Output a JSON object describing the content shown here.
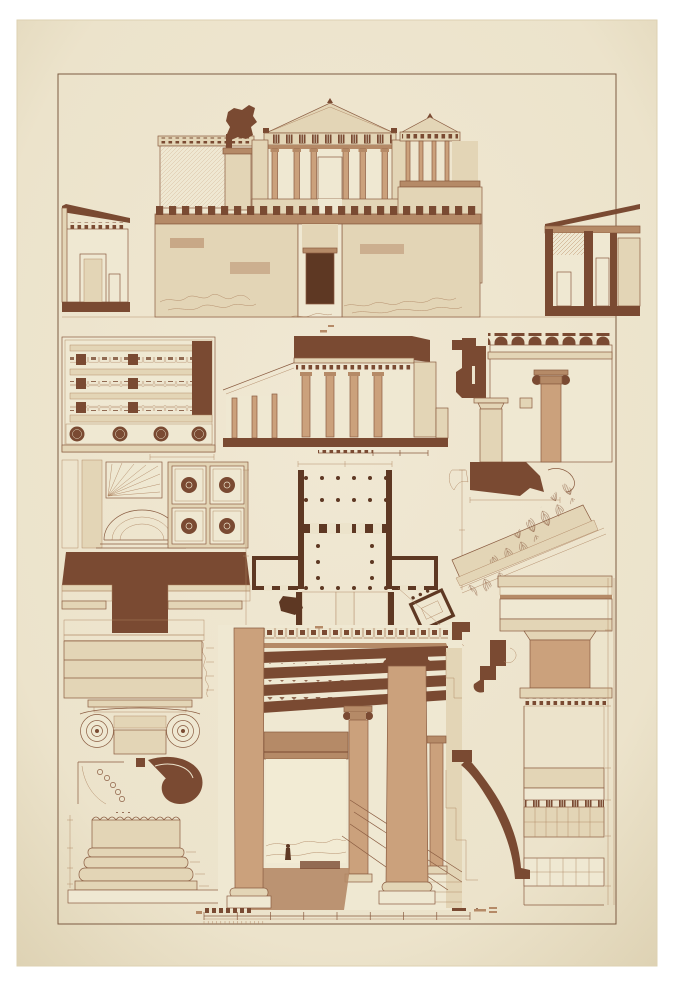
{
  "plate": {
    "description_semantic": "antique-architectural-plate-propylaea-acropolis",
    "palette": {
      "page_background": "#FFFFFF",
      "paper": "#ECE3CB",
      "paper_edge": "#DDD1B2",
      "paper_center": "#F0E8D3",
      "frame_line": "#7D5B42",
      "ink": "#8A5C41",
      "ink_light": "#AF8663",
      "fill_light": "#E3D5B6",
      "fill_pale": "#EFE8D2",
      "fill_tan": "#CBA17C",
      "fill_mid": "#B58A67",
      "fill_dark": "#7A4A32",
      "fill_darker": "#5E3823",
      "hatch": "#C09873",
      "sky": "#F2EBD4"
    },
    "paper_rect": {
      "x": 17,
      "y": 20,
      "width": 640,
      "height": 946
    },
    "frame_rect": {
      "x": 58,
      "y": 74,
      "width": 558,
      "height": 850
    },
    "figures": [
      {
        "id": "main-elevation",
        "kind": "restored-front-elevation",
        "bbox": [
          150,
          96,
          532,
          322
        ]
      },
      {
        "id": "wing-elevation-left",
        "kind": "side-building-elevation",
        "bbox": [
          62,
          196,
          130,
          316
        ]
      },
      {
        "id": "wing-elevation-right",
        "kind": "side-building-section",
        "bbox": [
          545,
          196,
          640,
          316
        ]
      },
      {
        "id": "ceiling-coffer-plan",
        "kind": "reflected-ceiling-plan",
        "bbox": [
          62,
          337,
          215,
          452
        ]
      },
      {
        "id": "longitudinal-section",
        "kind": "section-through-portico",
        "bbox": [
          223,
          330,
          448,
          458
        ]
      },
      {
        "id": "cross-section-crenellated",
        "kind": "section-ionic-doric-columns",
        "bbox": [
          452,
          333,
          612,
          462
        ]
      },
      {
        "id": "soffit-coffer-detail",
        "kind": "coffer-and-dome-detail",
        "bbox": [
          62,
          456,
          256,
          548
        ]
      },
      {
        "id": "anta-capital-profile",
        "kind": "dark-molding-profile",
        "bbox": [
          62,
          548,
          250,
          635
        ]
      },
      {
        "id": "ground-plan",
        "kind": "floor-plan-with-nike-temple",
        "bbox": [
          246,
          462,
          465,
          645
        ]
      },
      {
        "id": "raking-sima-detail",
        "kind": "pediment-cornice-ornament",
        "bbox": [
          448,
          455,
          612,
          586
        ]
      },
      {
        "id": "doric-entablature-detail",
        "kind": "triglyph-entablature-and-column",
        "bbox": [
          496,
          575,
          614,
          706
        ]
      },
      {
        "id": "architrave-fasciae-detail",
        "kind": "ionic-architrave",
        "bbox": [
          62,
          616,
          215,
          700
        ]
      },
      {
        "id": "ionic-capital-detail",
        "kind": "ionic-capital-front",
        "bbox": [
          62,
          690,
          215,
          808
        ]
      },
      {
        "id": "ionic-column-base",
        "kind": "column-base-detail",
        "bbox": [
          62,
          808,
          232,
          908
        ]
      },
      {
        "id": "perspective-view",
        "kind": "interior-colonnade-perspective",
        "bbox": [
          218,
          625,
          462,
          910
        ]
      },
      {
        "id": "cornice-step-profiles",
        "kind": "dark-stepped-profiles",
        "bbox": [
          446,
          620,
          534,
          712
        ]
      },
      {
        "id": "wall-section-right",
        "kind": "masonry-wall-section",
        "bbox": [
          446,
          706,
          614,
          916
        ]
      },
      {
        "id": "scale-bar",
        "kind": "metric-scale-bar",
        "bbox": [
          196,
          906,
          500,
          924
        ]
      }
    ],
    "scale_bar": {
      "x_start": 204,
      "x_end": 470,
      "y": 916,
      "major_ticks": 9,
      "left_blocks": 7
    },
    "counts": {
      "portico_columns": 6,
      "nike_temple_columns": 4,
      "section_columns": 4,
      "coffer_plan_circles": 4,
      "plan_front_columns": 6
    }
  }
}
